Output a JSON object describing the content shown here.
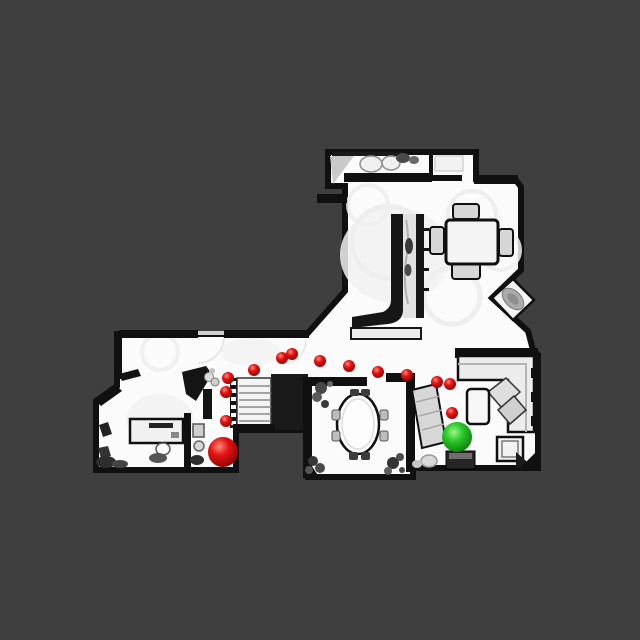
{
  "scene": {
    "background_color": "#3f3f3f",
    "floor_color": "#fbfbfb",
    "wall_color": "#101010"
  },
  "path": {
    "dot_color": "#e31313",
    "dot_highlight": "#ff8a78",
    "dot_shadow": "#7e0202",
    "dot_radius": 6,
    "waypoints": [
      {
        "x": 226,
        "y": 421
      },
      {
        "x": 226,
        "y": 392
      },
      {
        "x": 228,
        "y": 378
      },
      {
        "x": 254,
        "y": 370
      },
      {
        "x": 282,
        "y": 358
      },
      {
        "x": 292,
        "y": 354
      },
      {
        "x": 320,
        "y": 361
      },
      {
        "x": 349,
        "y": 366
      },
      {
        "x": 378,
        "y": 372
      },
      {
        "x": 407,
        "y": 375
      },
      {
        "x": 437,
        "y": 382
      },
      {
        "x": 450,
        "y": 384
      },
      {
        "x": 452,
        "y": 413
      }
    ]
  },
  "markers": {
    "start": {
      "x": 223,
      "y": 452,
      "radius": 15,
      "color": "#e31313"
    },
    "goal": {
      "x": 457,
      "y": 437,
      "radius": 15,
      "color": "#27c427",
      "highlight": "#9af587",
      "shadow": "#076d07"
    }
  }
}
